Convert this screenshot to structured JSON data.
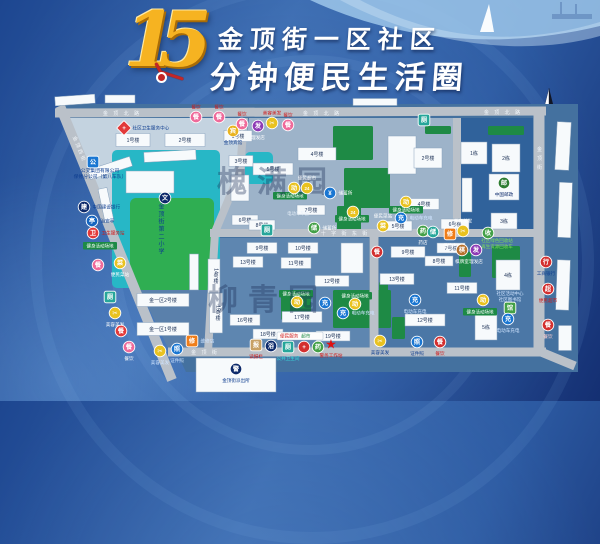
{
  "title": {
    "number": "15",
    "line1": "金顶街一区社区",
    "line2": "分钟便民生活圈"
  },
  "map": {
    "ground": "57,104 578,104 578,372 186,372",
    "ground_fill": "#44719f",
    "blocks": [
      {
        "pts": "66,118 244,118 239,175 214,232 112,232 70,131",
        "fill": "#c4d3e0"
      },
      {
        "pts": "114,237 212,237 205,348 168,348",
        "fill": "#5a80ab"
      },
      {
        "pts": "249,118 453,118 453,229 219,229 242,173",
        "fill": "#9db3c9"
      },
      {
        "pts": "461,118 533,118 533,229 461,229",
        "fill": "#30629b"
      },
      {
        "pts": "212,238 369,238 369,348 207,348",
        "fill": "#5e86b0"
      },
      {
        "pts": "379,238 534,238 534,348 379,348",
        "fill": "#4b77a6"
      }
    ],
    "teals": [
      [
        112,
        150,
        108,
        138
      ],
      [
        245,
        152,
        28,
        32
      ]
    ],
    "school_field": [
      130,
      198,
      84,
      92
    ],
    "greens": [
      [
        333,
        126,
        40,
        34
      ],
      [
        344,
        168,
        46,
        40
      ],
      [
        337,
        206,
        24,
        24
      ],
      [
        488,
        126,
        36,
        9
      ],
      [
        464,
        142,
        22,
        6
      ],
      [
        333,
        290,
        58,
        38
      ],
      [
        281,
        295,
        30,
        25
      ],
      [
        492,
        246,
        28,
        32
      ],
      [
        459,
        252,
        12,
        25
      ],
      [
        392,
        317,
        13,
        22
      ],
      [
        379,
        282,
        9,
        36
      ],
      [
        425,
        126,
        26,
        8
      ]
    ],
    "road_color": "#bac1c9",
    "roads": [
      [
        55,
        113,
        546,
        111,
        9
      ],
      [
        210,
        233,
        540,
        233,
        8
      ],
      [
        168,
        352,
        546,
        352,
        9
      ],
      [
        539,
        110,
        539,
        353,
        11
      ],
      [
        60,
        106,
        172,
        380,
        10
      ],
      [
        374,
        237,
        374,
        352,
        9
      ],
      [
        457,
        118,
        457,
        233,
        8
      ],
      [
        541,
        352,
        575,
        366,
        9
      ]
    ],
    "road_curve": "M244,118 L240,172 L215,232 L208,352",
    "road_labels": [
      {
        "t": "金 顶 北 路",
        "x": 122,
        "y": 115
      },
      {
        "t": "金 顶 北 路",
        "x": 322,
        "y": 115
      },
      {
        "t": "金 顶 北 路",
        "x": 503,
        "y": 114
      },
      {
        "t": "十 字 街 东 街",
        "x": 345,
        "y": 235
      },
      {
        "t": "金  顶  街",
        "x": 205,
        "y": 354
      },
      {
        "t": "金顶街",
        "x": 539,
        "y": 160,
        "vert": 1
      },
      {
        "t": "金顶西街",
        "x": 78,
        "y": 150,
        "rot": 68
      }
    ],
    "buildings": [
      [
        75,
        100,
        40,
        9,
        "",
        -4
      ],
      [
        120,
        99,
        30,
        8,
        "",
        0
      ],
      [
        375,
        102,
        44,
        7,
        "",
        0
      ],
      [
        110,
        168,
        44,
        10,
        "",
        -18
      ],
      [
        106,
        205,
        9,
        34,
        "",
        -12
      ],
      [
        150,
        182,
        48,
        22,
        "",
        0
      ],
      [
        170,
        156,
        52,
        10,
        "",
        -3
      ],
      [
        194,
        272,
        9,
        36,
        "",
        0
      ],
      [
        240,
        188,
        18,
        26,
        "",
        0
      ],
      [
        402,
        155,
        28,
        38,
        "",
        0
      ],
      [
        467,
        195,
        10,
        34,
        "",
        0
      ],
      [
        352,
        258,
        22,
        30,
        "",
        0
      ],
      [
        563,
        146,
        14,
        48,
        "",
        3
      ],
      [
        565,
        210,
        13,
        55,
        "",
        2
      ],
      [
        563,
        285,
        13,
        50,
        "",
        2
      ],
      [
        565,
        338,
        13,
        25,
        "",
        0
      ],
      [
        133,
        140,
        34,
        13,
        "1号楼"
      ],
      [
        185,
        140,
        40,
        13,
        "2号楼"
      ],
      [
        163,
        300,
        52,
        13,
        "金一区2号楼"
      ],
      [
        163,
        329,
        52,
        13,
        "金一区1号楼"
      ],
      [
        238,
        136,
        28,
        11,
        "1号楼"
      ],
      [
        241,
        161,
        24,
        11,
        "3号楼"
      ],
      [
        273,
        169,
        40,
        12,
        "5号楼"
      ],
      [
        317,
        154,
        38,
        13,
        "4号楼"
      ],
      [
        245,
        220,
        26,
        10,
        "6号楼"
      ],
      [
        262,
        225,
        26,
        10,
        "8号楼"
      ],
      [
        311,
        210,
        28,
        10,
        "7号楼"
      ],
      [
        428,
        158,
        28,
        20,
        "2号楼"
      ],
      [
        424,
        204,
        30,
        11,
        "4号楼"
      ],
      [
        398,
        226,
        28,
        10,
        "5号楼"
      ],
      [
        455,
        224,
        28,
        10,
        "6号楼"
      ],
      [
        474,
        153,
        26,
        22,
        "1栋"
      ],
      [
        506,
        158,
        28,
        28,
        "2栋"
      ],
      [
        504,
        187,
        30,
        26,
        ""
      ],
      [
        504,
        221,
        26,
        16,
        "3栋"
      ],
      [
        214,
        276,
        12,
        34,
        "14号楼",
        "v"
      ],
      [
        216,
        313,
        13,
        40,
        "15号楼",
        "v"
      ],
      [
        262,
        248,
        30,
        11,
        "9号楼"
      ],
      [
        303,
        248,
        30,
        11,
        "10号楼"
      ],
      [
        248,
        262,
        30,
        11,
        "13号楼"
      ],
      [
        296,
        263,
        30,
        11,
        "11号楼"
      ],
      [
        332,
        281,
        34,
        11,
        "12号楼"
      ],
      [
        245,
        320,
        30,
        11,
        "16号楼"
      ],
      [
        302,
        317,
        40,
        11,
        "17号楼"
      ],
      [
        268,
        334,
        30,
        10,
        "18号楼"
      ],
      [
        333,
        336,
        34,
        10,
        "19号楼"
      ],
      [
        408,
        252,
        34,
        11,
        "9号楼"
      ],
      [
        451,
        248,
        28,
        10,
        "7号楼"
      ],
      [
        439,
        261,
        28,
        10,
        "8号楼"
      ],
      [
        397,
        279,
        34,
        11,
        "13号楼"
      ],
      [
        462,
        288,
        30,
        11,
        "11号楼"
      ],
      [
        425,
        320,
        40,
        12,
        "12号楼"
      ],
      [
        508,
        275,
        24,
        30,
        "4栋"
      ],
      [
        486,
        327,
        22,
        26,
        "5栋"
      ],
      [
        236,
        375,
        80,
        34,
        ""
      ]
    ],
    "sign_text": "健身活动场地",
    "signs": [
      [
        100,
        246
      ],
      [
        290,
        196
      ],
      [
        352,
        219
      ],
      [
        296,
        294
      ],
      [
        355,
        296
      ],
      [
        480,
        312
      ],
      [
        406,
        210
      ]
    ],
    "white_sign": {
      "x": 300,
      "y": 336,
      "w": 46,
      "h": 8,
      "parts": [
        {
          "t": "便民服务",
          "c": "#d01818"
        },
        {
          "t": "超市",
          "c": "#1d8a45"
        }
      ]
    },
    "texts": [
      {
        "x": 100,
        "y": 172,
        "ls": [
          "公交集团有限公司",
          "保修分公司（第八车队）"
        ],
        "c": "#0d3c8f",
        "s": 4.8
      },
      {
        "x": 497,
        "y": 242,
        "ls": [
          "社区绿色回收站",
          "再生资源回收车"
        ],
        "c": "#7ddb5a",
        "s": 4.5
      },
      {
        "x": 510,
        "y": 295,
        "ls": [
          "社区活动中心",
          "社区图书馆"
        ],
        "c": "#cfe4ff",
        "s": 4.5
      },
      {
        "x": 298,
        "y": 215,
        "ls": [
          "电动车车棚"
        ],
        "c": "#e8f1fa",
        "s": 4.3
      },
      {
        "x": 160,
        "y": 203,
        "ls": [
          "金顶街第二小学"
        ],
        "c": "#0d3c8f",
        "s": 6,
        "vert": 1
      }
    ],
    "watermarks": [
      {
        "t": "槐满园",
        "x": 277,
        "y": 192
      },
      {
        "t": "柳青园",
        "x": 268,
        "y": 310
      }
    ],
    "pois": [
      [
        124,
        128,
        "+",
        "#e23a3a",
        "d",
        "社区卫生服务中心",
        "r",
        "#0d3c8f"
      ],
      [
        196,
        117,
        "餐",
        "#ef6a9a",
        "c",
        "餐饮",
        "t",
        "#d01818"
      ],
      [
        219,
        117,
        "餐",
        "#ef6a9a",
        "c",
        "餐饮",
        "t",
        "#d01818"
      ],
      [
        233,
        131,
        "宾",
        "#e9b31f",
        "c",
        "金顶宾馆",
        "b",
        "#0d3c8f"
      ],
      [
        242,
        124,
        "餐",
        "#ef6a9a",
        "c",
        "餐饮",
        "t",
        "#d01818"
      ],
      [
        258,
        126,
        "发",
        "#8e3bb5",
        "c",
        "理发店",
        "b",
        "#ffffff"
      ],
      [
        272,
        123,
        "✂",
        "#e9c21f",
        "c",
        "美容美发",
        "t",
        "#d01818"
      ],
      [
        288,
        125,
        "餐",
        "#ef6a9a",
        "c",
        "餐饮",
        "t",
        "#d01818"
      ],
      [
        93,
        162,
        "公",
        "#1976d2",
        "s",
        null
      ],
      [
        84,
        207,
        "建",
        "#0d2a6b",
        "c",
        "中国建设银行",
        "r",
        "#0d3c8f"
      ],
      [
        92,
        221,
        "亭",
        "#1565c0",
        "c",
        "治安亭",
        "r",
        "#0d3c8f"
      ],
      [
        93,
        233,
        "卫",
        "#e23a3a",
        "c",
        "卫生服务站",
        "r",
        "#d01818"
      ],
      [
        98,
        265,
        "餐",
        "#ef6a9a",
        "c",
        null
      ],
      [
        120,
        263,
        "菜",
        "#e9c21f",
        "c",
        "便民菜站",
        "b",
        "#ffffff"
      ],
      [
        110,
        297,
        "厕",
        "#26a69a",
        "s",
        null
      ],
      [
        115,
        313,
        "✂",
        "#e9c21f",
        "c",
        "美容美发",
        "b",
        "#ffffff"
      ],
      [
        121,
        331,
        "餐",
        "#e23a3a",
        "c",
        null
      ],
      [
        129,
        347,
        "餐",
        "#ef6a9a",
        "c",
        "餐饮",
        "b",
        "#ffffff"
      ],
      [
        160,
        351,
        "✂",
        "#e9c21f",
        "c",
        "美容美发",
        "b",
        "#cfe4ff"
      ],
      [
        177,
        349,
        "照",
        "#1976d2",
        "c",
        "证件照",
        "b",
        "#cfe4ff"
      ],
      [
        192,
        341,
        "修",
        "#ef7d19",
        "s",
        "维修店",
        "r",
        "#cfe4ff"
      ],
      [
        165,
        198,
        "文",
        "#0d2a6b",
        "c",
        null
      ],
      [
        307,
        188,
        "24",
        "#e9c21f",
        "c",
        "便民超市",
        "t",
        "#ffffff"
      ],
      [
        330,
        193,
        "¥",
        "#1976d2",
        "c",
        "储蓄所",
        "r",
        "#ffffff"
      ],
      [
        294,
        188,
        "动",
        "#e9c21f",
        "c",
        null
      ],
      [
        353,
        212,
        "24",
        "#e9c21f",
        "c",
        null
      ],
      [
        267,
        230,
        "厕",
        "#26a69a",
        "s",
        null
      ],
      [
        314,
        228,
        "储",
        "#43a047",
        "c",
        "储蓄所",
        "r",
        "#ffffff"
      ],
      [
        383,
        226,
        "菜",
        "#e9c21f",
        "c",
        "便民菜站",
        "t",
        "#ffffff"
      ],
      [
        406,
        202,
        "动",
        "#e9c21f",
        "c",
        null
      ],
      [
        401,
        218,
        "充",
        "#1976d2",
        "c",
        "电动车充电",
        "r",
        "#cfe4ff"
      ],
      [
        423,
        231,
        "药",
        "#43a047",
        "c",
        "药店",
        "b",
        "#ffffff"
      ],
      [
        433,
        232,
        "储",
        "#26a69a",
        "c",
        null
      ],
      [
        450,
        234,
        "修",
        "#ef7d19",
        "s",
        "维修店",
        "b",
        "#ffffff"
      ],
      [
        463,
        231,
        "✂",
        "#e9c21f",
        "c",
        "美容美发",
        "t",
        "#ffffff"
      ],
      [
        488,
        233,
        "收",
        "#43a047",
        "c",
        null
      ],
      [
        462,
        250,
        "棋",
        "#b5712e",
        "c",
        "棋牌室",
        "b",
        "#ffffff"
      ],
      [
        476,
        250,
        "发",
        "#8e3bb5",
        "c",
        "理发店",
        "b",
        "#ffffff"
      ],
      [
        548,
        325,
        "餐",
        "#d32f2f",
        "c",
        "餐饮",
        "b",
        "#ffd0d0"
      ],
      [
        546,
        262,
        "行",
        "#d32f2f",
        "c",
        "工商银行",
        "b",
        "#0d3c8f"
      ],
      [
        548,
        289,
        "超",
        "#d32f2f",
        "c",
        "便民超市",
        "b",
        "#d01818"
      ],
      [
        256,
        345,
        "报",
        "#c8a165",
        "s",
        "读报栏",
        "b",
        "#d01818"
      ],
      [
        271,
        346,
        "浴",
        "#0d2a6b",
        "c",
        null
      ],
      [
        288,
        347,
        "厕",
        "#26a69a",
        "s",
        "公共卫生间",
        "b",
        "#35e0e0"
      ],
      [
        304,
        347,
        "+",
        "#d32f2f",
        "c",
        null
      ],
      [
        318,
        347,
        "药",
        "#43a047",
        "c",
        null
      ],
      [
        331,
        344,
        "★",
        "#e01010",
        "t",
        "警务工作站",
        "b",
        "#d01818"
      ],
      [
        297,
        302,
        "动",
        "#e9c21f",
        "c",
        null
      ],
      [
        355,
        304,
        "动",
        "#e9c21f",
        "c",
        null
      ],
      [
        325,
        303,
        "充",
        "#1976d2",
        "c",
        null
      ],
      [
        343,
        313,
        "充",
        "#1976d2",
        "c",
        "电动车充电",
        "r",
        "#cfe4ff"
      ],
      [
        415,
        300,
        "充",
        "#1976d2",
        "c",
        "电动车充电",
        "b",
        "#cfe4ff"
      ],
      [
        483,
        300,
        "动",
        "#e9c21f",
        "c",
        null
      ],
      [
        510,
        308,
        "馆",
        "#43a047",
        "s",
        null
      ],
      [
        508,
        319,
        "充",
        "#1976d2",
        "c",
        "电动车充电",
        "b",
        "#cfe4ff"
      ],
      [
        504,
        183,
        "邮",
        "#2e7d32",
        "c",
        "中国邮政",
        "b",
        "#0d2a6b"
      ],
      [
        424,
        120,
        "厕",
        "#26a69a",
        "s",
        null
      ],
      [
        377,
        252,
        "餐",
        "#d32f2f",
        "c",
        null
      ],
      [
        380,
        341,
        "✂",
        "#e9c21f",
        "c",
        "美容美发",
        "b",
        "#0d3c8f"
      ],
      [
        417,
        342,
        "照",
        "#1976d2",
        "c",
        "证件照",
        "b",
        "#0d3c8f"
      ],
      [
        440,
        342,
        "餐",
        "#d32f2f",
        "c",
        "餐饮",
        "b",
        "#d01818"
      ],
      [
        236,
        369,
        "警",
        "#0d2a6b",
        "c",
        "金顶街派出所",
        "b",
        "#0d3c8f"
      ]
    ]
  }
}
